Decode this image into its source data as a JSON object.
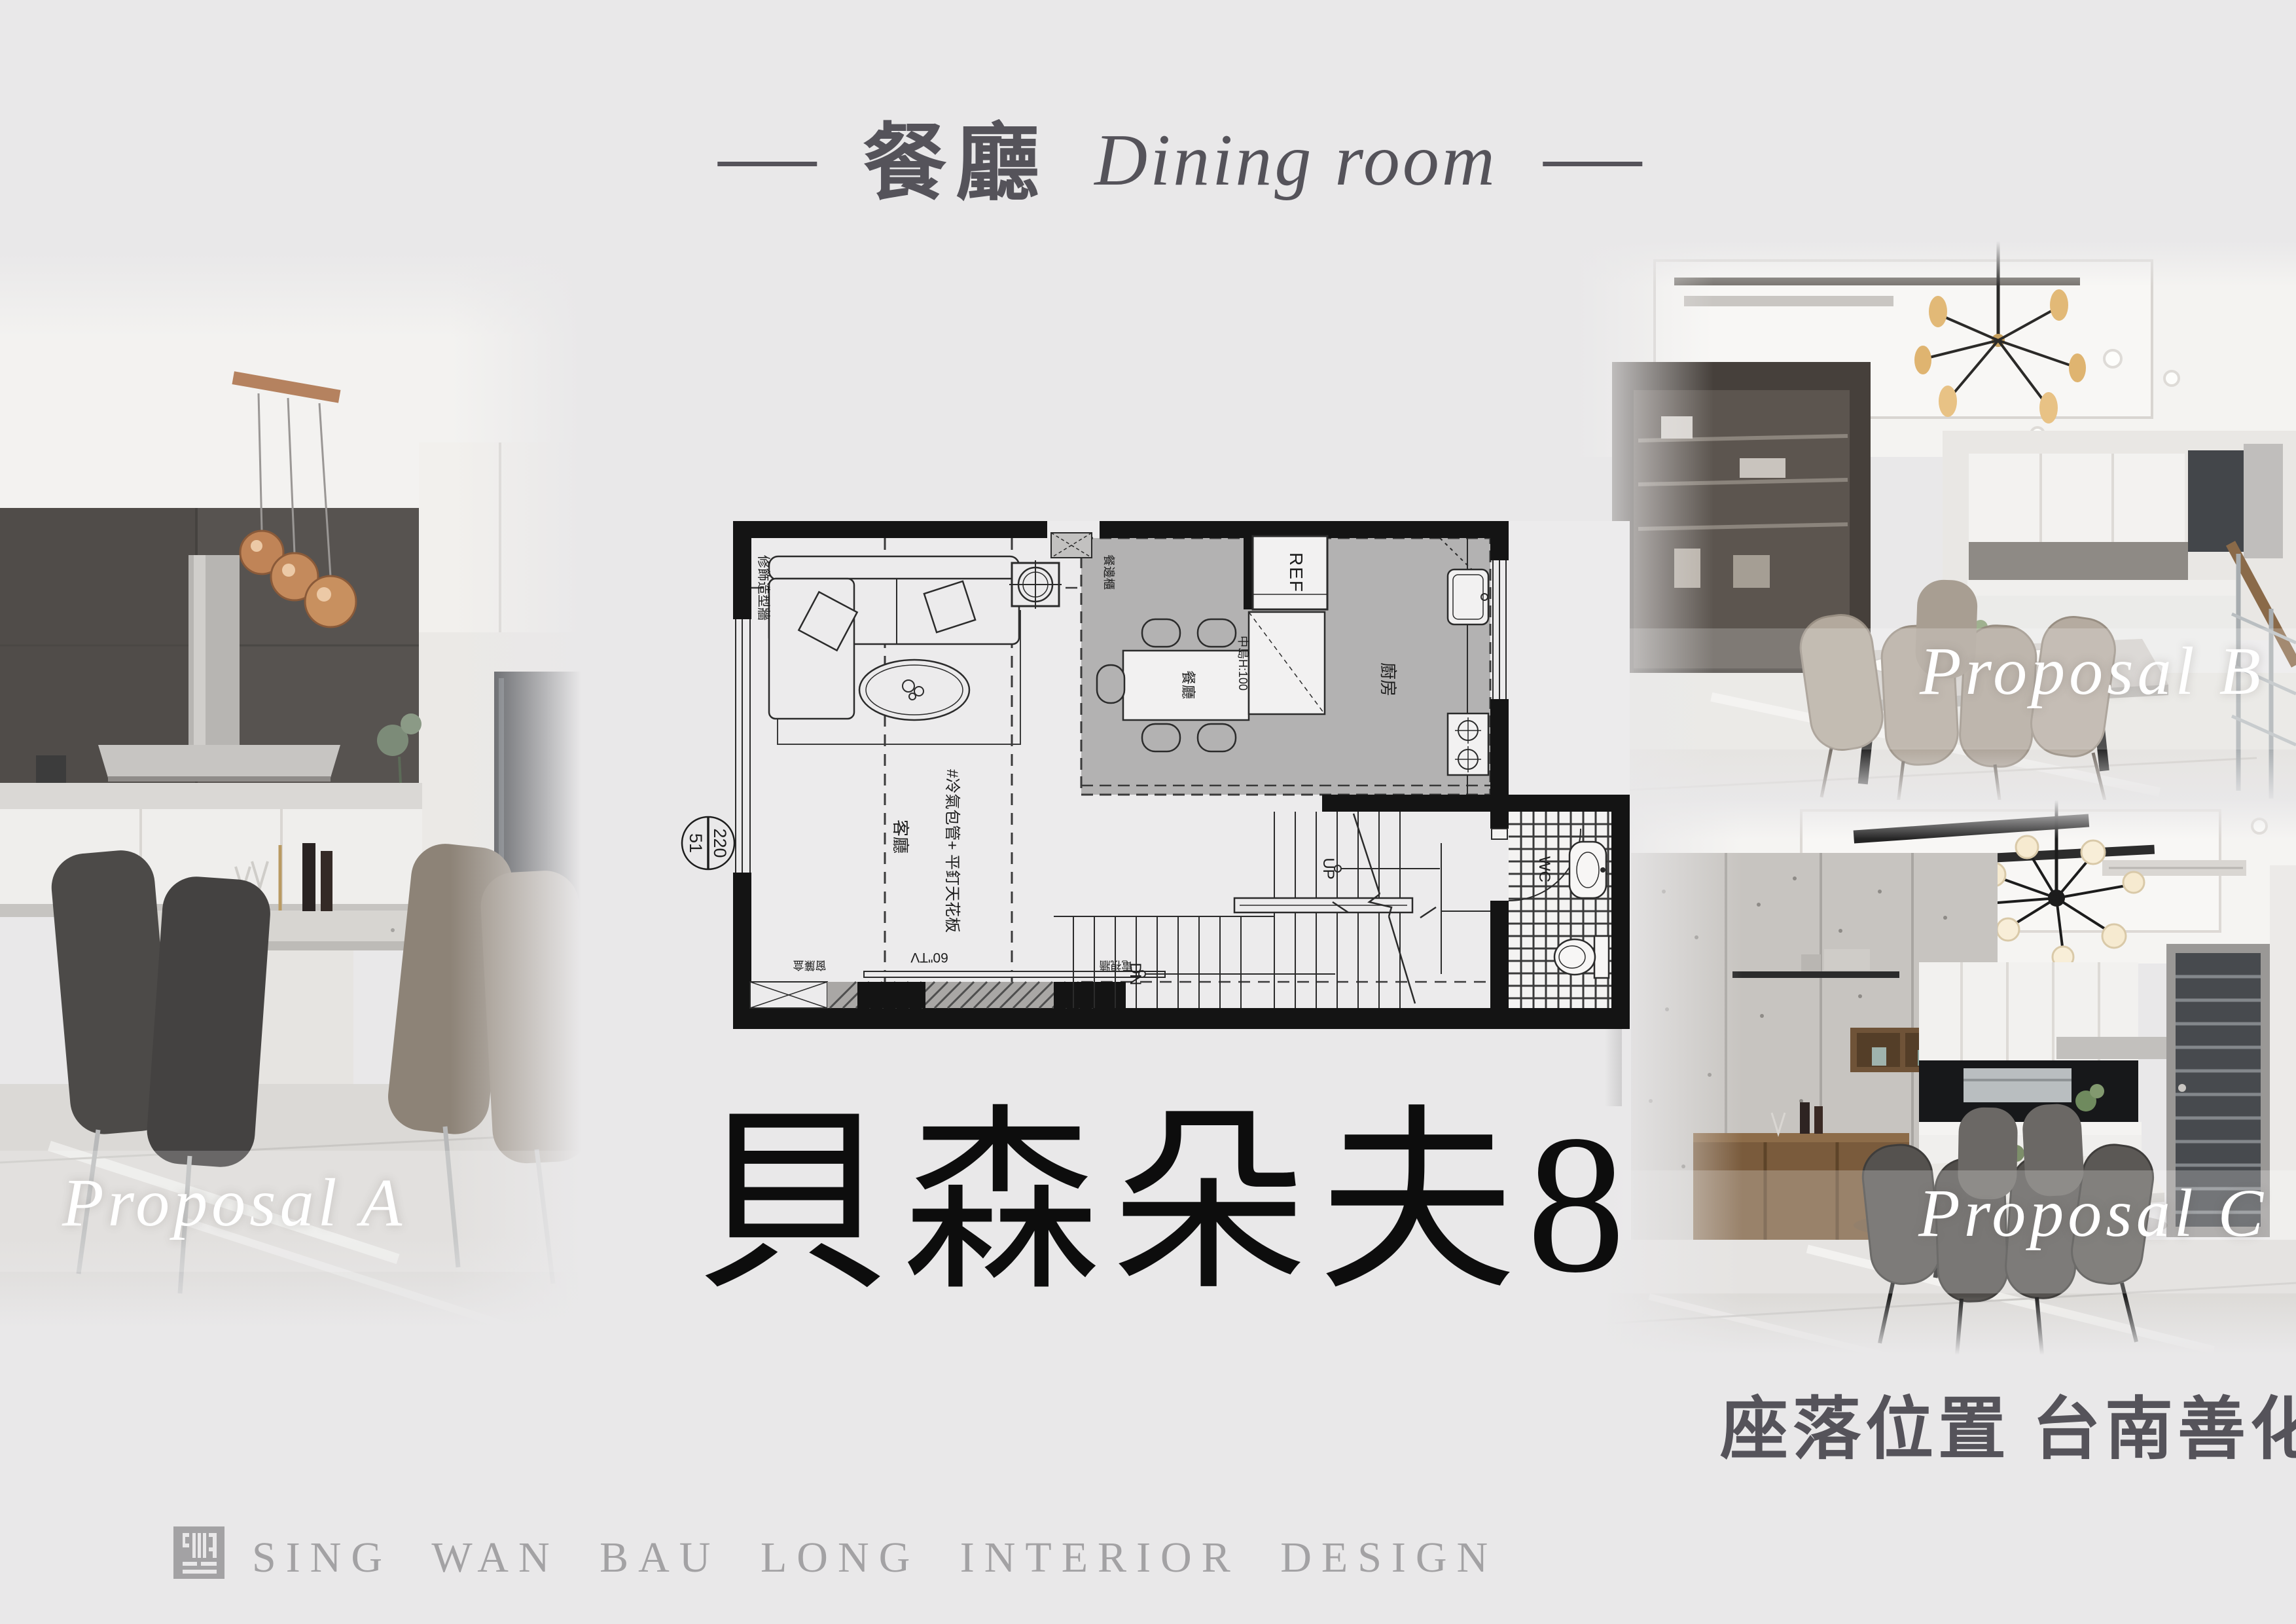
{
  "page": {
    "background": "#e9e8e9",
    "ink": "#0d0d0d",
    "muted_text": "#55535a"
  },
  "header": {
    "title_zh": "餐廳",
    "title_en": "Dining room"
  },
  "proposals": [
    {
      "id": "A",
      "label": "Proposal A"
    },
    {
      "id": "B",
      "label": "Proposal B"
    },
    {
      "id": "C",
      "label": "Proposal C"
    }
  ],
  "project": {
    "name": "貝森朵夫8",
    "location": "座落位置 台南善化區"
  },
  "floor_plan": {
    "elevation_marker": {
      "top": "220",
      "bottom": "51"
    },
    "labels": {
      "wall_finish": "修飾造型牆",
      "dining_cabinet": "餐邊櫃",
      "ref": "REF",
      "dining_table": "餐廳",
      "island": "中島H:100",
      "kitchen": "廚房",
      "living": "客廳",
      "ceiling_note": "#冷氣包管+ 平釘天花板",
      "tv": "60\"TV",
      "curtain_box": "窗簾盒",
      "tv_wall": "電視牆",
      "up": "UP",
      "dn": "DN",
      "wc": "WC"
    }
  },
  "footer": {
    "company": "SING WAN BAU LONG INTERIOR DESIGN",
    "logo": "sing-wan-bau-long-seal"
  }
}
